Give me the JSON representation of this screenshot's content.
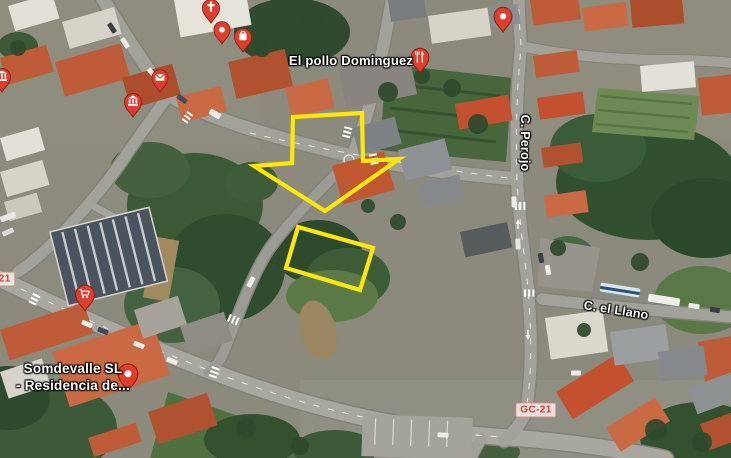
{
  "map": {
    "poi_labels": [
      {
        "name": "el-pollo-dominguez-label",
        "text": "El pollo Dominguez",
        "x": 351,
        "y": 61,
        "rotate": 0,
        "size": 13,
        "interactable": true
      },
      {
        "name": "somdevalle-label",
        "text": "Somdevalle SL\n- Residencia de...",
        "x": 73,
        "y": 378,
        "rotate": 0,
        "size": 13.5,
        "interactable": true
      }
    ],
    "street_labels": [
      {
        "name": "c-perojo-label",
        "text": "C. Perojo",
        "x": 524,
        "y": 143,
        "rotate": 90,
        "size": 12.5,
        "interactable": false
      },
      {
        "name": "c-el-llano-label",
        "text": "C. el Llano",
        "x": 616,
        "y": 311,
        "rotate": 9,
        "size": 12.5,
        "interactable": false
      }
    ],
    "route_badges": [
      {
        "name": "route-badge-gc21",
        "text": "GC-21",
        "x": 536,
        "y": 410
      },
      {
        "name": "route-badge-gc21-clipped",
        "text": "GC-21",
        "x": -5,
        "y": 279
      }
    ],
    "pins": [
      {
        "name": "pin-museum-left",
        "icon": "museum",
        "x": 2,
        "y": 92,
        "scale": 1
      },
      {
        "name": "pin-museum-center",
        "icon": "museum",
        "x": 133,
        "y": 117,
        "scale": 1
      },
      {
        "name": "pin-post-office",
        "icon": "envelope",
        "x": 160,
        "y": 92,
        "scale": 0.95
      },
      {
        "name": "pin-church",
        "icon": "cross",
        "x": 211,
        "y": 23,
        "scale": 1
      },
      {
        "name": "pin-place-top",
        "icon": "dot",
        "x": 222,
        "y": 44,
        "scale": 0.95
      },
      {
        "name": "pin-shopping",
        "icon": "bag",
        "x": 243,
        "y": 52,
        "scale": 1
      },
      {
        "name": "pin-restaurant-el-pollo",
        "icon": "restaurant",
        "x": 420,
        "y": 73,
        "scale": 1.05
      },
      {
        "name": "pin-place-topright",
        "icon": "dot",
        "x": 503,
        "y": 32,
        "scale": 1.05
      },
      {
        "name": "pin-supermarket",
        "icon": "cart",
        "x": 85,
        "y": 311,
        "scale": 1.1
      },
      {
        "name": "pin-somdevalle",
        "icon": "dot",
        "x": 128,
        "y": 391,
        "scale": 1.15
      }
    ],
    "annotations": {
      "color": "#FFE70A",
      "arrow_points": "293,117 362,113 363,161 399,159 325,211 254,166 292,163",
      "rect_points": "298,227 373,248 360,290 286,268"
    }
  }
}
